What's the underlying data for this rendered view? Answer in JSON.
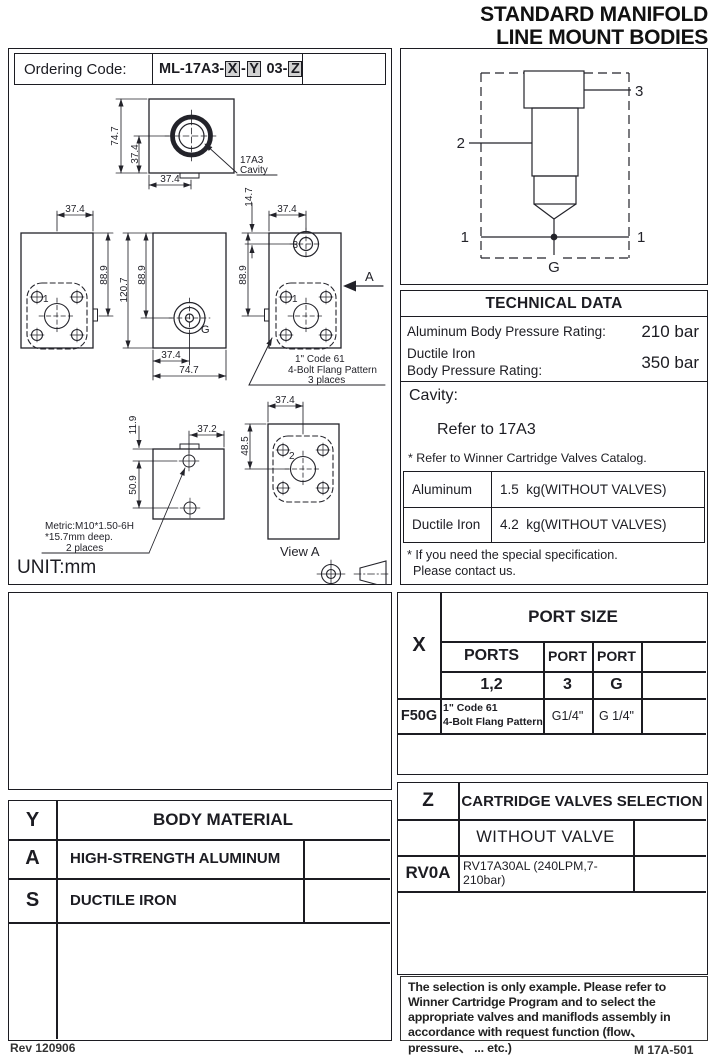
{
  "header": {
    "title_line1": "STANDARD MANIFOLD",
    "title_line2": "LINE MOUNT BODIES"
  },
  "ordering": {
    "label": "Ordering Code:",
    "prefix": "ML-17A3-",
    "box_x": "X",
    "dash1": "-",
    "box_y": "Y",
    "mid": " 03-",
    "box_z": "Z"
  },
  "drawing": {
    "unit": "UNIT:mm",
    "cavity_callout_l1": "17A3",
    "cavity_callout_l2": "Cavity",
    "flange_callout_l1": "1\" Code 61",
    "flange_callout_l2": "4-Bolt Flang Pattern",
    "flange_callout_l3": "3 places",
    "metric_callout_l1": "Metric:M10*1.50-6H",
    "metric_callout_l2": "*15.7mm deep.",
    "metric_callout_l3": "2 places",
    "view_a": "View A",
    "section_arrow": "A",
    "dim_cavity_h": "74.7",
    "dim_cavity_half_v": "37.4",
    "dim_cavity_half_h": "37.4",
    "dim_ml_top": "37.4",
    "dim_ml_side": "88.9",
    "dim_mc_h": "120.7",
    "dim_mc_port": "88.9",
    "dim_mc_half": "37.4",
    "dim_mc_w": "74.7",
    "dim_mr_offset": "14.7",
    "dim_mr_top": "37.4",
    "dim_mr_side": "88.9",
    "dim_bl_top": "11.9",
    "dim_bl_pitch": "50.9",
    "dim_bl_w": "37.2",
    "dim_va_top": "37.4",
    "dim_va_side": "48.5",
    "port1": "1",
    "port2": "2",
    "port3": "3",
    "portg": "G"
  },
  "schematic": {
    "port1_left": "1",
    "port1_right": "1",
    "port2": "2",
    "port3": "3",
    "portg": "G"
  },
  "tech": {
    "title": "TECHNICAL DATA",
    "row1_label": "Aluminum Body Pressure Rating:",
    "row1_value": "210 bar",
    "row2_label_l1": "Ductile Iron",
    "row2_label_l2": "Body Pressure Rating:",
    "row2_value": "350 bar",
    "cavity_label": "Cavity:",
    "cavity_value": "Refer to 17A3",
    "cavity_note": "* Refer to Winner Cartridge Valves Catalog.",
    "weights": [
      {
        "material": "Aluminum",
        "value": "1.5  kg(WITHOUT VALVES)"
      },
      {
        "material": "Ductile Iron",
        "value": "4.2  kg(WITHOUT VALVES)"
      }
    ],
    "special_l1": "* If you need the special specification.",
    "special_l2": "Please contact us."
  },
  "port_table": {
    "key": "X",
    "title": "PORT SIZE",
    "h_ports": "PORTS",
    "h_port3": "PORT",
    "h_portg": "PORT",
    "v_ports": "1,2",
    "v_port3": "3",
    "v_portg": "G",
    "row_key": "F50G",
    "row_ports_l1": "1\" Code 61",
    "row_ports_l2": "4-Bolt Flang Pattern",
    "row_port3": "G1/4\"",
    "row_portg": "G 1/4\""
  },
  "z_table": {
    "key": "Z",
    "title": "CARTRIDGE VALVES SELECTION",
    "option1": "WITHOUT VALVE",
    "option2_key": "RV0A",
    "option2_value": "RV17A30AL (240LPM,7-210bar)"
  },
  "body_table": {
    "key": "Y",
    "title": "BODY MATERIAL",
    "rows": [
      {
        "code": "A",
        "material": "HIGH-STRENGTH ALUMINUM"
      },
      {
        "code": "S",
        "material": "DUCTILE IRON"
      }
    ]
  },
  "note": {
    "text": "The selection is only example. Please refer to Winner Cartridge Program and to select the appropriate valves and maniflods assembly in accordance with request function (flow、pressure、 ... etc.)"
  },
  "page": {
    "footer_left": "Rev 120906",
    "footer_right": "M 17A-501"
  }
}
